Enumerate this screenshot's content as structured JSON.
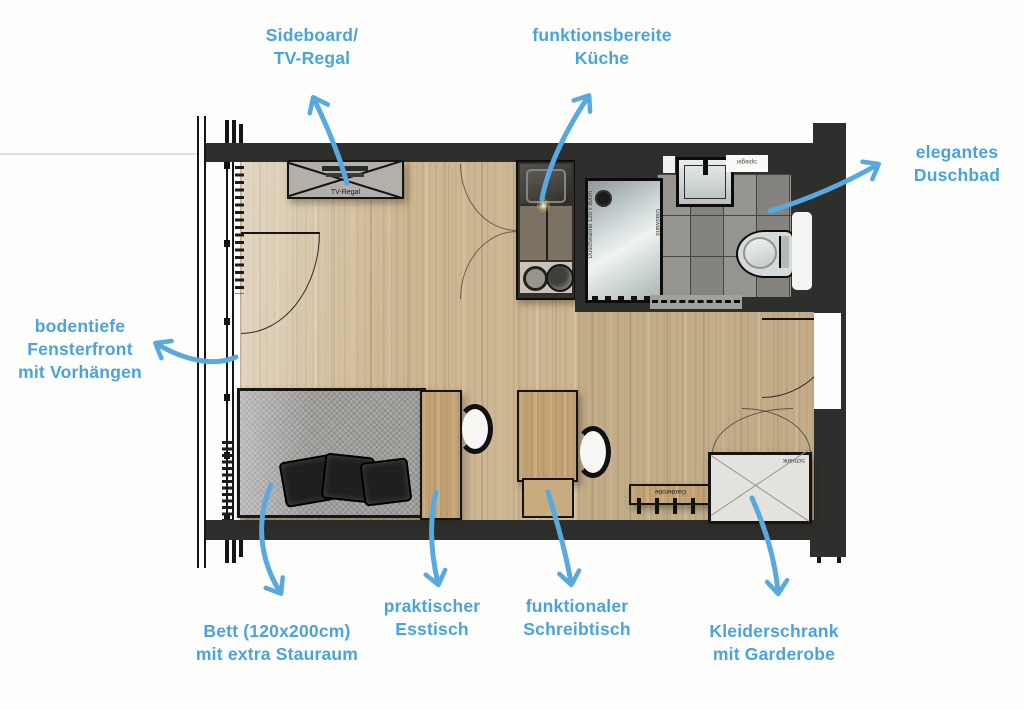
{
  "annotations": {
    "sideboard": "Sideboard/\nTV-Regal",
    "kitchen": "funktionsbereite\nKüche",
    "bathroom": "elegantes\nDuschbad",
    "window": "bodentiefe\nFensterfront\nmit Vorhängen",
    "bed": "Bett (120x200cm)\nmit extra Stauraum",
    "dining": "praktischer\nEsstisch",
    "desk": "funktionaler\nSchreibtisch",
    "wardrobe": "Kleiderschrank\nmit Garderobe"
  },
  "plan_texts": {
    "tv_shelf": "TV-Regal",
    "coat_rack": "Garderobe",
    "closet": "Schrank",
    "mirror": "Spiegel",
    "shower_tray": "Duschwanne 120 x 80cm",
    "glass_wall": "Glaswand"
  },
  "colors": {
    "annotation_blue": "#4aa3dc",
    "arrow_blue": "#57a9e0",
    "wall_dark": "#2e2e2c",
    "wood_floor": "#cdb792",
    "furniture_wood": "#c2a273",
    "tile_gray": "#8f8e89"
  }
}
